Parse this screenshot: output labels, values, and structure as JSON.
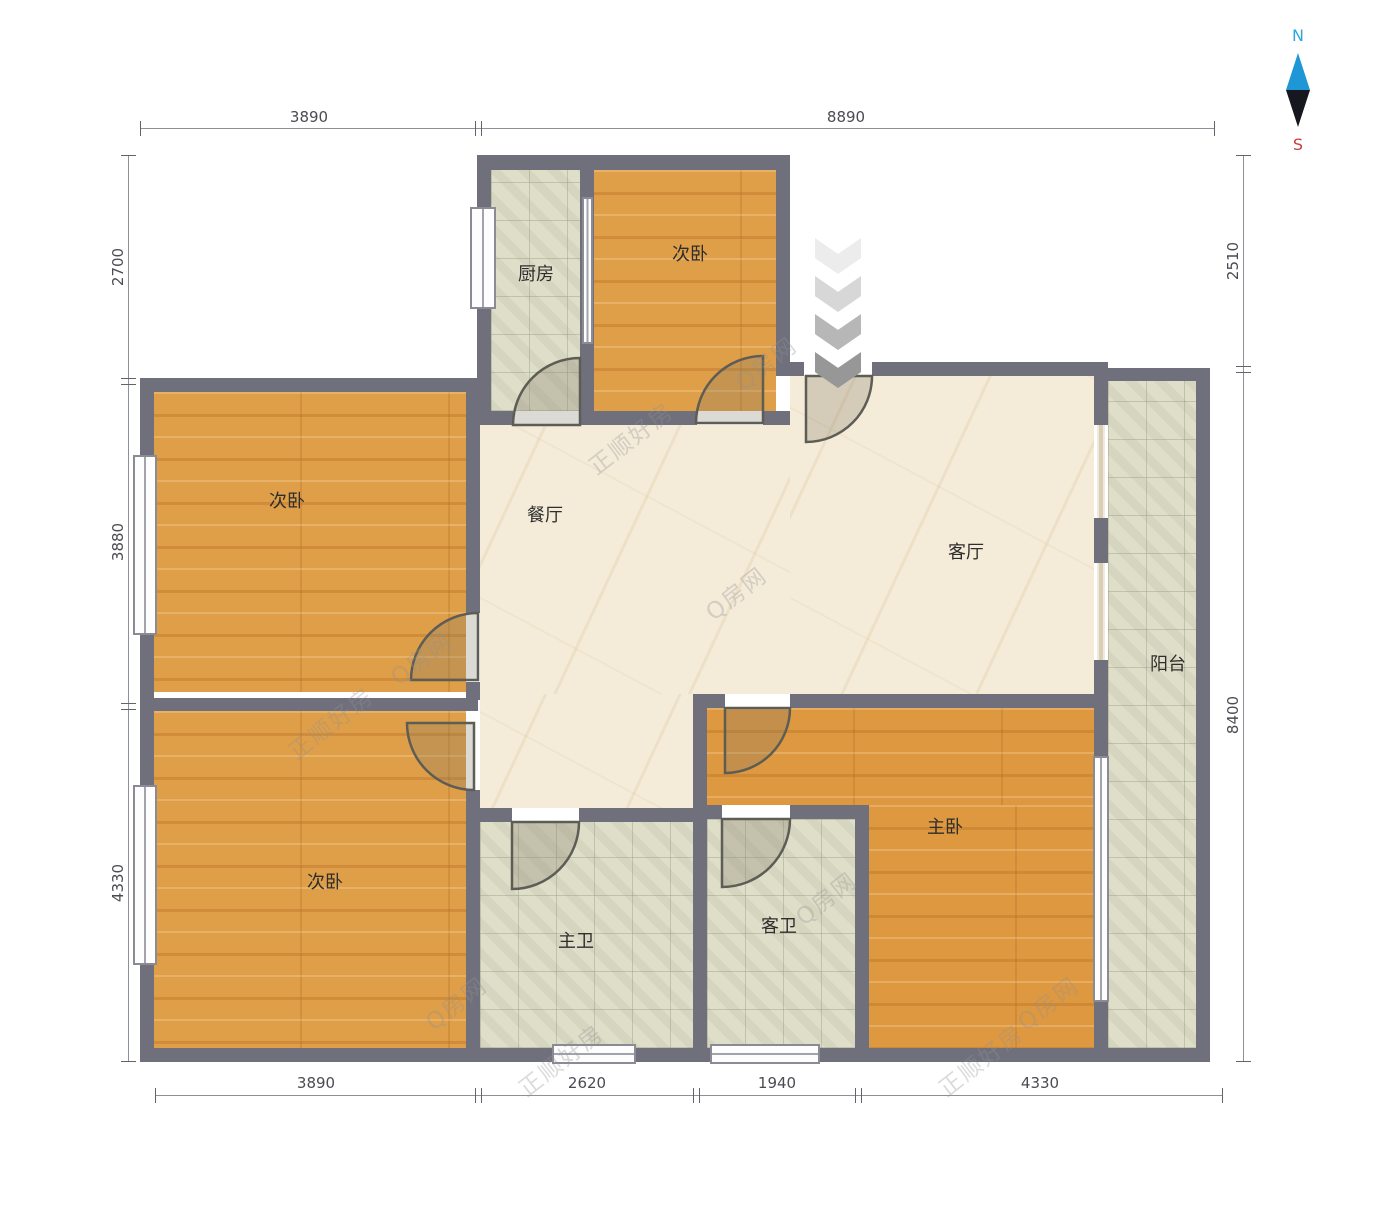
{
  "compass": {
    "north": "N",
    "south": "S"
  },
  "rooms": {
    "kitchen": "厨房",
    "bedroom_top": "次卧",
    "bedroom_left_upper": "次卧",
    "bedroom_left_lower": "次卧",
    "dining": "餐厅",
    "living": "客厅",
    "balcony": "阳台",
    "master_bedroom": "主卧",
    "master_bath": "主卫",
    "guest_bath": "客卫"
  },
  "dimensions": {
    "top": {
      "d1": "3890",
      "d2": "8890"
    },
    "bottom": {
      "d1": "3890",
      "d2": "2620",
      "d3": "1940",
      "d4": "4330"
    },
    "left": {
      "d1": "2700",
      "d2": "3880",
      "d3": "4330"
    },
    "right": {
      "d1": "2510",
      "d2": "8400"
    }
  },
  "watermarks": {
    "brand": "正顺好房",
    "site": "Q房网"
  },
  "colors": {
    "wall": "#70707c",
    "wood_floor": "#df9e48",
    "tile_floor": "#dedec9",
    "marble_floor": "#f4ebd9",
    "north_accent": "#2da7dd",
    "south_accent": "#c4403c"
  }
}
